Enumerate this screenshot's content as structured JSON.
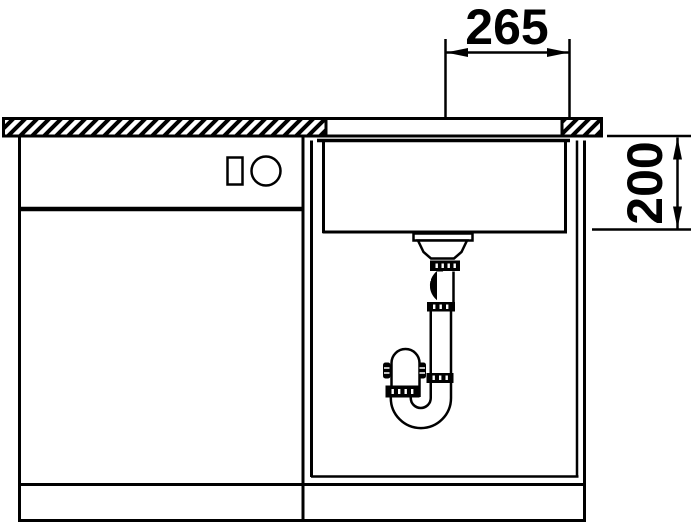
{
  "diagram": {
    "background_color": "#ffffff",
    "line_color": "#000000",
    "dimensions": {
      "horizontal": {
        "value": "265",
        "orientation": "horizontal",
        "location": "top"
      },
      "vertical": {
        "value": "200",
        "orientation": "vertical",
        "location": "right"
      }
    }
  }
}
